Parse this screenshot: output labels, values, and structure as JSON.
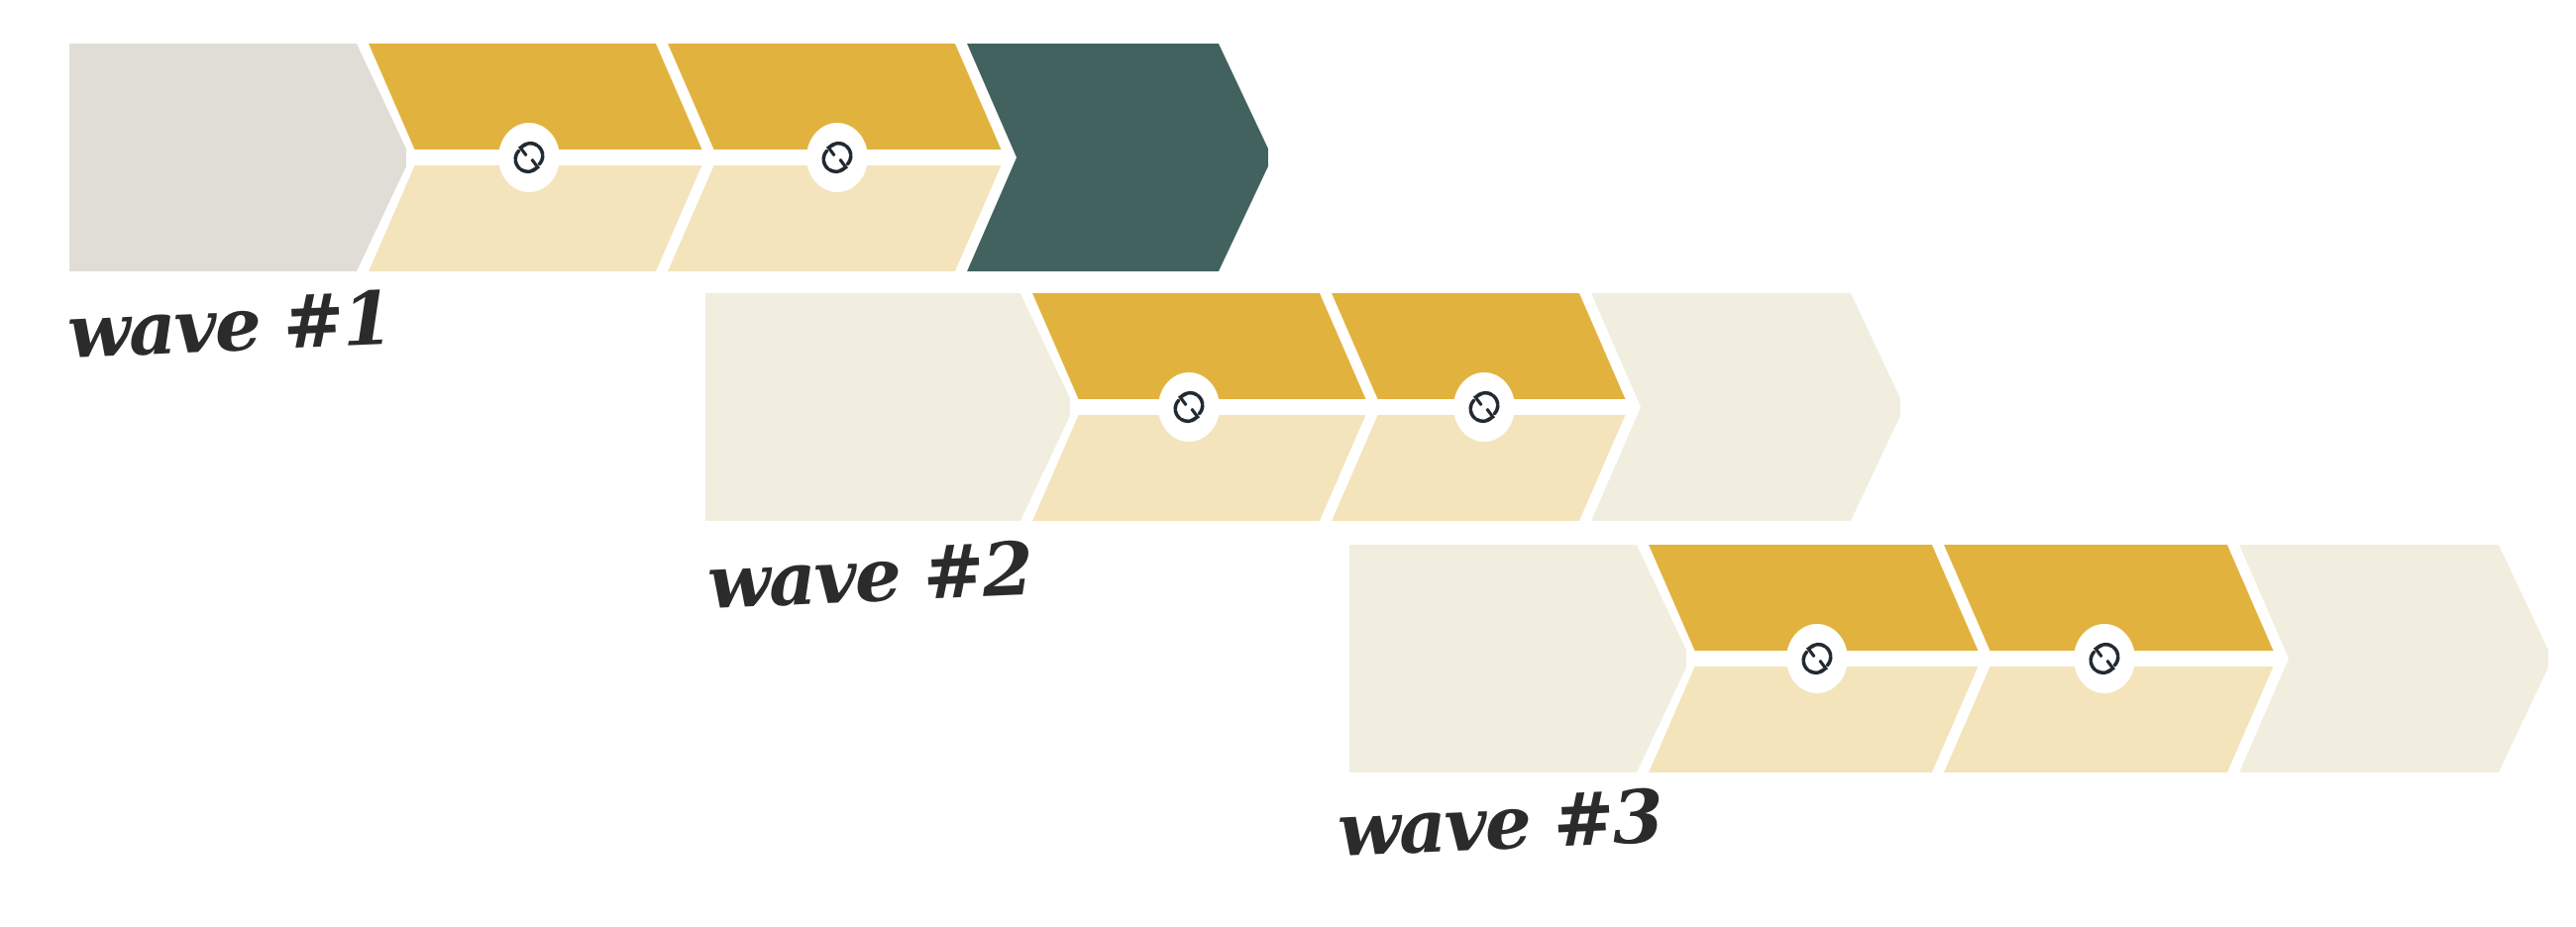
{
  "diagram": {
    "type": "chevron-process-waves",
    "background": "#ffffff"
  },
  "colors": {
    "gold": "#e2b23e",
    "gold_light": "#f4e4bc",
    "cream": "#f1eee0",
    "gray": "#e0ddd7",
    "teal": "#426260",
    "icon_stroke": "#212a32",
    "icon_bg": "#ffffff",
    "label": "#2b2b2b"
  },
  "waves": [
    {
      "label": "wave #1",
      "segments": [
        {
          "name": "start",
          "style": "solid",
          "color": "gray",
          "icon": null
        },
        {
          "name": "cycle-1",
          "style": "split",
          "color": "gold",
          "icon": "sync-icon"
        },
        {
          "name": "cycle-2",
          "style": "split",
          "color": "gold",
          "icon": "sync-icon"
        },
        {
          "name": "end",
          "style": "solid",
          "color": "teal",
          "icon": null
        }
      ]
    },
    {
      "label": "wave #2",
      "segments": [
        {
          "name": "start",
          "style": "solid",
          "color": "cream",
          "icon": null
        },
        {
          "name": "cycle-1",
          "style": "split",
          "color": "gold",
          "icon": "sync-icon"
        },
        {
          "name": "cycle-2",
          "style": "split",
          "color": "gold",
          "icon": "sync-icon"
        },
        {
          "name": "end",
          "style": "solid",
          "color": "cream",
          "icon": null
        }
      ]
    },
    {
      "label": "wave #3",
      "segments": [
        {
          "name": "start",
          "style": "solid",
          "color": "cream",
          "icon": null
        },
        {
          "name": "cycle-1",
          "style": "split",
          "color": "gold",
          "icon": "sync-icon"
        },
        {
          "name": "cycle-2",
          "style": "split",
          "color": "gold",
          "icon": "sync-icon"
        },
        {
          "name": "end",
          "style": "solid",
          "color": "cream",
          "icon": null
        }
      ]
    }
  ]
}
